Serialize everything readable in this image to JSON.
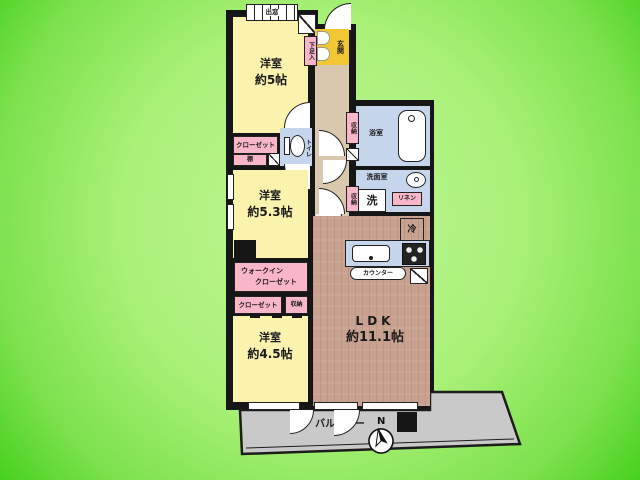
{
  "plan": {
    "compass_label": "N",
    "balcony_label": "バルコニー",
    "rooms": {
      "western5": {
        "name": "洋室",
        "size": "約5帖"
      },
      "western53": {
        "name": "洋室",
        "size": "約5.3帖"
      },
      "western45": {
        "name": "洋室",
        "size": "約4.5帖"
      },
      "ldk": {
        "name": "LDK",
        "size": "約11.1帖"
      }
    },
    "labels": {
      "bay_window": "出窓",
      "entrance": "玄関",
      "shoe_box": "下足入",
      "closet_a": "クローゼット",
      "shelf": "棚",
      "toilet": "トイレ",
      "storage_a": "収納",
      "bath": "浴室",
      "washroom": "洗面室",
      "washer": "洗",
      "storage_b": "収納",
      "linen": "リネン",
      "fridge": "冷",
      "wic_line1": "ウォークイン",
      "wic_line2": "クローゼット",
      "closet_b": "クローゼット",
      "storage_c": "収納",
      "counter": "カウンター"
    },
    "colors": {
      "background_green": "#7ce14c",
      "wall": "#161616",
      "room_yellow": "#fbf2ae",
      "entrance_gold": "#f2c733",
      "closet_pink": "#f9b6c8",
      "wet_blue": "#c5d5ec",
      "hall_beige": "#d9c8ae",
      "ldk_wood": "#c9a190",
      "balcony_gray": "#c9c9c9"
    }
  }
}
